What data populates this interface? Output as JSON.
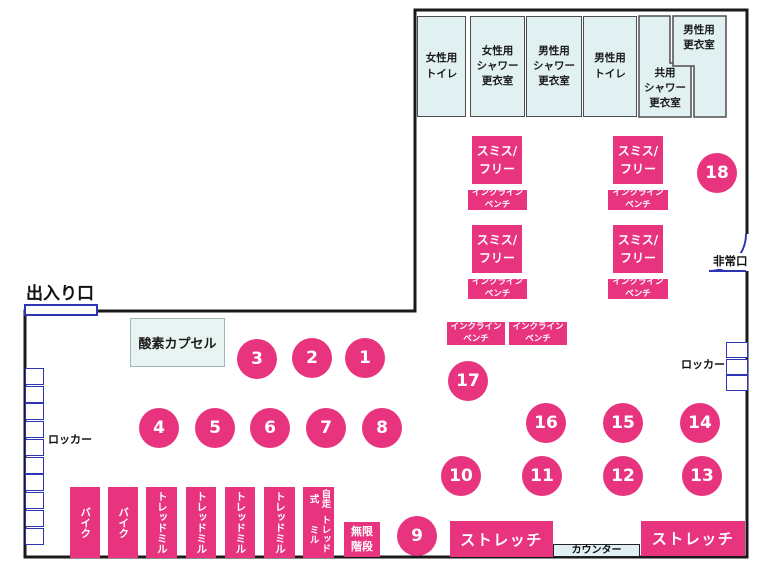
{
  "plan": {
    "entrance": {
      "label": "出入り口"
    },
    "emergency_exit": {
      "label": "非常口"
    },
    "oxygen_capsule": {
      "label": "酸素カプセル"
    },
    "lockers": {
      "left_label": "ロッカー",
      "right_label": "ロッカー"
    },
    "counter": {
      "label": "カウンター"
    },
    "infinite_stairs": {
      "label": "無限\n階段"
    },
    "stretch_zones": [
      {
        "label": "ストレッチ"
      },
      {
        "label": "ストレッチ"
      }
    ],
    "rooms_l_shaped": {
      "shared_shower": {
        "label": "共用\nシャワー\n更衣室"
      },
      "mens_locker_room": {
        "label": "男性用\n更衣室"
      }
    },
    "colors": {
      "accent_pink": "#e8337f",
      "room_fill": "#e1f0f0",
      "door_blue": "#2e35b5",
      "wall_black": "#1a1a1a"
    }
  },
  "collections": [
    {
      "class": "room",
      "item_name": "room",
      "items": [
        {
          "name": "room-womens-toilet",
          "label": "女性用\nトイレ",
          "x": 417,
          "y": 16,
          "w": 49,
          "h": 101
        },
        {
          "name": "room-womens-shower-locker",
          "label": "女性用\nシャワー\n更衣室",
          "x": 470,
          "y": 16,
          "w": 55,
          "h": 101
        },
        {
          "name": "room-mens-shower-locker",
          "label": "男性用\nシャワー\n更衣室",
          "x": 526,
          "y": 16,
          "w": 56,
          "h": 101
        },
        {
          "name": "room-mens-toilet",
          "label": "男性用\nトイレ",
          "x": 583,
          "y": 16,
          "w": 54,
          "h": 101
        }
      ]
    },
    {
      "class": "pinkbox smith",
      "item_name": "smith-free-rack",
      "items": [
        {
          "label": "スミス/\nフリー",
          "x": 472,
          "y": 136,
          "w": 50,
          "h": 48
        },
        {
          "label": "スミス/\nフリー",
          "x": 613,
          "y": 136,
          "w": 50,
          "h": 48
        },
        {
          "label": "スミス/\nフリー",
          "x": 472,
          "y": 225,
          "w": 50,
          "h": 48
        },
        {
          "label": "スミス/\nフリー",
          "x": 613,
          "y": 225,
          "w": 50,
          "h": 48
        }
      ]
    },
    {
      "class": "pinkbox bench",
      "item_name": "incline-bench",
      "items": [
        {
          "label": "インクライン\nベンチ",
          "x": 468,
          "y": 190,
          "w": 59,
          "h": 20
        },
        {
          "label": "インクライン\nベンチ",
          "x": 608,
          "y": 190,
          "w": 60,
          "h": 20
        },
        {
          "label": "インクライン\nベンチ",
          "x": 468,
          "y": 279,
          "w": 59,
          "h": 20
        },
        {
          "label": "インクライン\nベンチ",
          "x": 608,
          "y": 279,
          "w": 60,
          "h": 20
        },
        {
          "label": "インクライン\nベンチ",
          "x": 447,
          "y": 322,
          "w": 58,
          "h": 23
        },
        {
          "label": "インクライン\nベンチ",
          "x": 509,
          "y": 322,
          "w": 58,
          "h": 23
        }
      ]
    },
    {
      "class": "circle",
      "item_name": "machine-station-number",
      "items": [
        {
          "label": "1",
          "x": 345,
          "y": 338
        },
        {
          "label": "2",
          "x": 292,
          "y": 338
        },
        {
          "label": "3",
          "x": 237,
          "y": 339
        },
        {
          "label": "4",
          "x": 139,
          "y": 408
        },
        {
          "label": "5",
          "x": 195,
          "y": 408
        },
        {
          "label": "6",
          "x": 250,
          "y": 408
        },
        {
          "label": "7",
          "x": 306,
          "y": 408
        },
        {
          "label": "8",
          "x": 362,
          "y": 408
        },
        {
          "label": "9",
          "x": 397,
          "y": 516
        },
        {
          "label": "10",
          "x": 441,
          "y": 456
        },
        {
          "label": "11",
          "x": 522,
          "y": 456
        },
        {
          "label": "12",
          "x": 603,
          "y": 456
        },
        {
          "label": "13",
          "x": 682,
          "y": 456
        },
        {
          "label": "14",
          "x": 680,
          "y": 403
        },
        {
          "label": "15",
          "x": 603,
          "y": 403
        },
        {
          "label": "16",
          "x": 526,
          "y": 403
        },
        {
          "label": "17",
          "x": 448,
          "y": 361
        },
        {
          "label": "18",
          "x": 697,
          "y": 153
        }
      ]
    },
    {
      "class": "pinkbox cardio",
      "item_name": "cardio-machine",
      "items": [
        {
          "name": "cardio-bike",
          "label": "バイク",
          "x": 70,
          "y": 487,
          "w": 30,
          "h": 71
        },
        {
          "name": "cardio-bike",
          "label": "バイク",
          "x": 108,
          "y": 487,
          "w": 30,
          "h": 71
        },
        {
          "name": "cardio-treadmill",
          "label": "トレッドミル",
          "x": 146,
          "y": 487,
          "w": 31,
          "h": 71
        },
        {
          "name": "cardio-treadmill",
          "label": "トレッドミル",
          "x": 186,
          "y": 487,
          "w": 30,
          "h": 71
        },
        {
          "name": "cardio-treadmill",
          "label": "トレッドミル",
          "x": 225,
          "y": 487,
          "w": 30,
          "h": 71
        },
        {
          "name": "cardio-treadmill",
          "label": "トレッドミル",
          "x": 264,
          "y": 487,
          "w": 31,
          "h": 71
        },
        {
          "name": "cardio-self-propelled-treadmill",
          "parts": [
            "自走式",
            "トレッドミル"
          ],
          "x": 303,
          "y": 487,
          "w": 31,
          "h": 71,
          "fs": 9.5
        }
      ]
    },
    {
      "class": "locker",
      "item_name": "locker-cell",
      "items": [
        {
          "x": 25,
          "y": 368,
          "w": 19,
          "h": 17
        },
        {
          "x": 25,
          "y": 386,
          "w": 19,
          "h": 17
        },
        {
          "x": 25,
          "y": 403,
          "w": 19,
          "h": 17
        },
        {
          "x": 25,
          "y": 421,
          "w": 19,
          "h": 17
        },
        {
          "x": 25,
          "y": 439,
          "w": 19,
          "h": 17
        },
        {
          "x": 25,
          "y": 457,
          "w": 19,
          "h": 17
        },
        {
          "x": 25,
          "y": 474,
          "w": 19,
          "h": 17
        },
        {
          "x": 25,
          "y": 492,
          "w": 19,
          "h": 17
        },
        {
          "x": 25,
          "y": 510,
          "w": 19,
          "h": 17
        },
        {
          "x": 25,
          "y": 528,
          "w": 19,
          "h": 17
        },
        {
          "x": 726,
          "y": 342,
          "w": 22,
          "h": 16
        },
        {
          "x": 726,
          "y": 359,
          "w": 22,
          "h": 16
        },
        {
          "x": 726,
          "y": 375,
          "w": 22,
          "h": 16
        }
      ]
    }
  ]
}
